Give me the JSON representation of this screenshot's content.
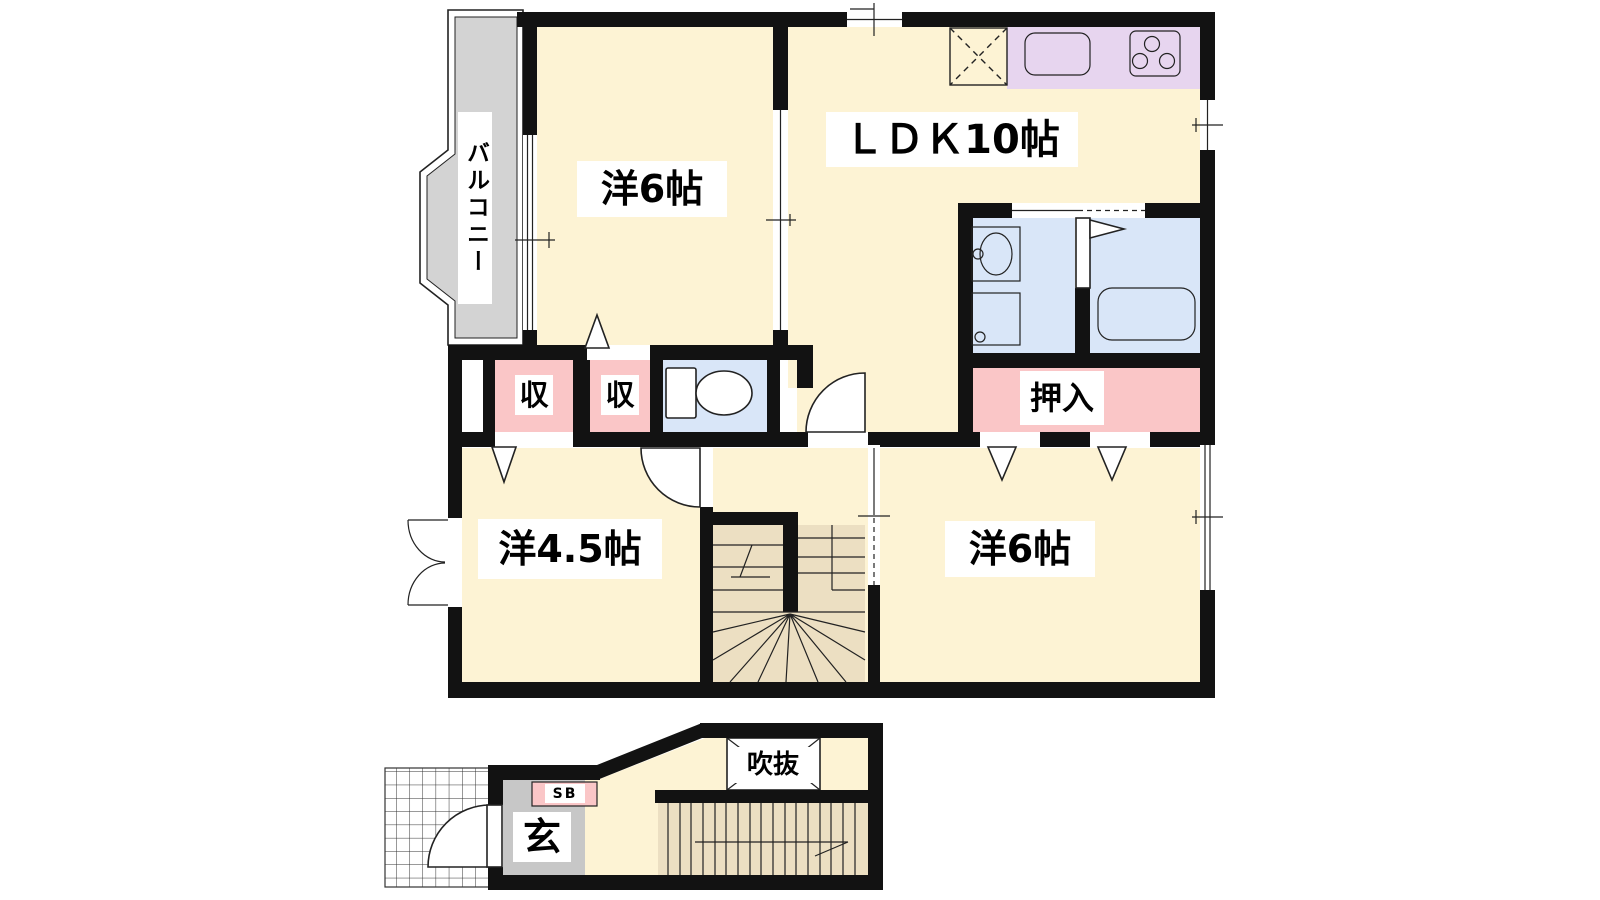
{
  "colors": {
    "wall": "#121212",
    "outline": "#222222",
    "room_cream": "#fdf3d4",
    "stair_beige": "#ecdfc2",
    "closet_pink": "#fac6c7",
    "water_blue": "#d9e6f8",
    "kitchen_purple": "#e7d5ef",
    "balcony_gray": "#d3d3d3",
    "genkan_gray": "#c7c7c7"
  },
  "floor_plan": {
    "second_floor": {
      "ldk": "ＬＤＫ10帖",
      "western_room_upper": "洋6帖",
      "western_room_small": "洋4.5帖",
      "western_room_lower": "洋6帖",
      "oshiire_closet": "押入",
      "closet_left": "収",
      "closet_right": "収",
      "balcony": "バルコニー"
    },
    "first_floor": {
      "void_atrium": "吹抜",
      "entrance": "玄",
      "shoe_box": "SB"
    }
  }
}
